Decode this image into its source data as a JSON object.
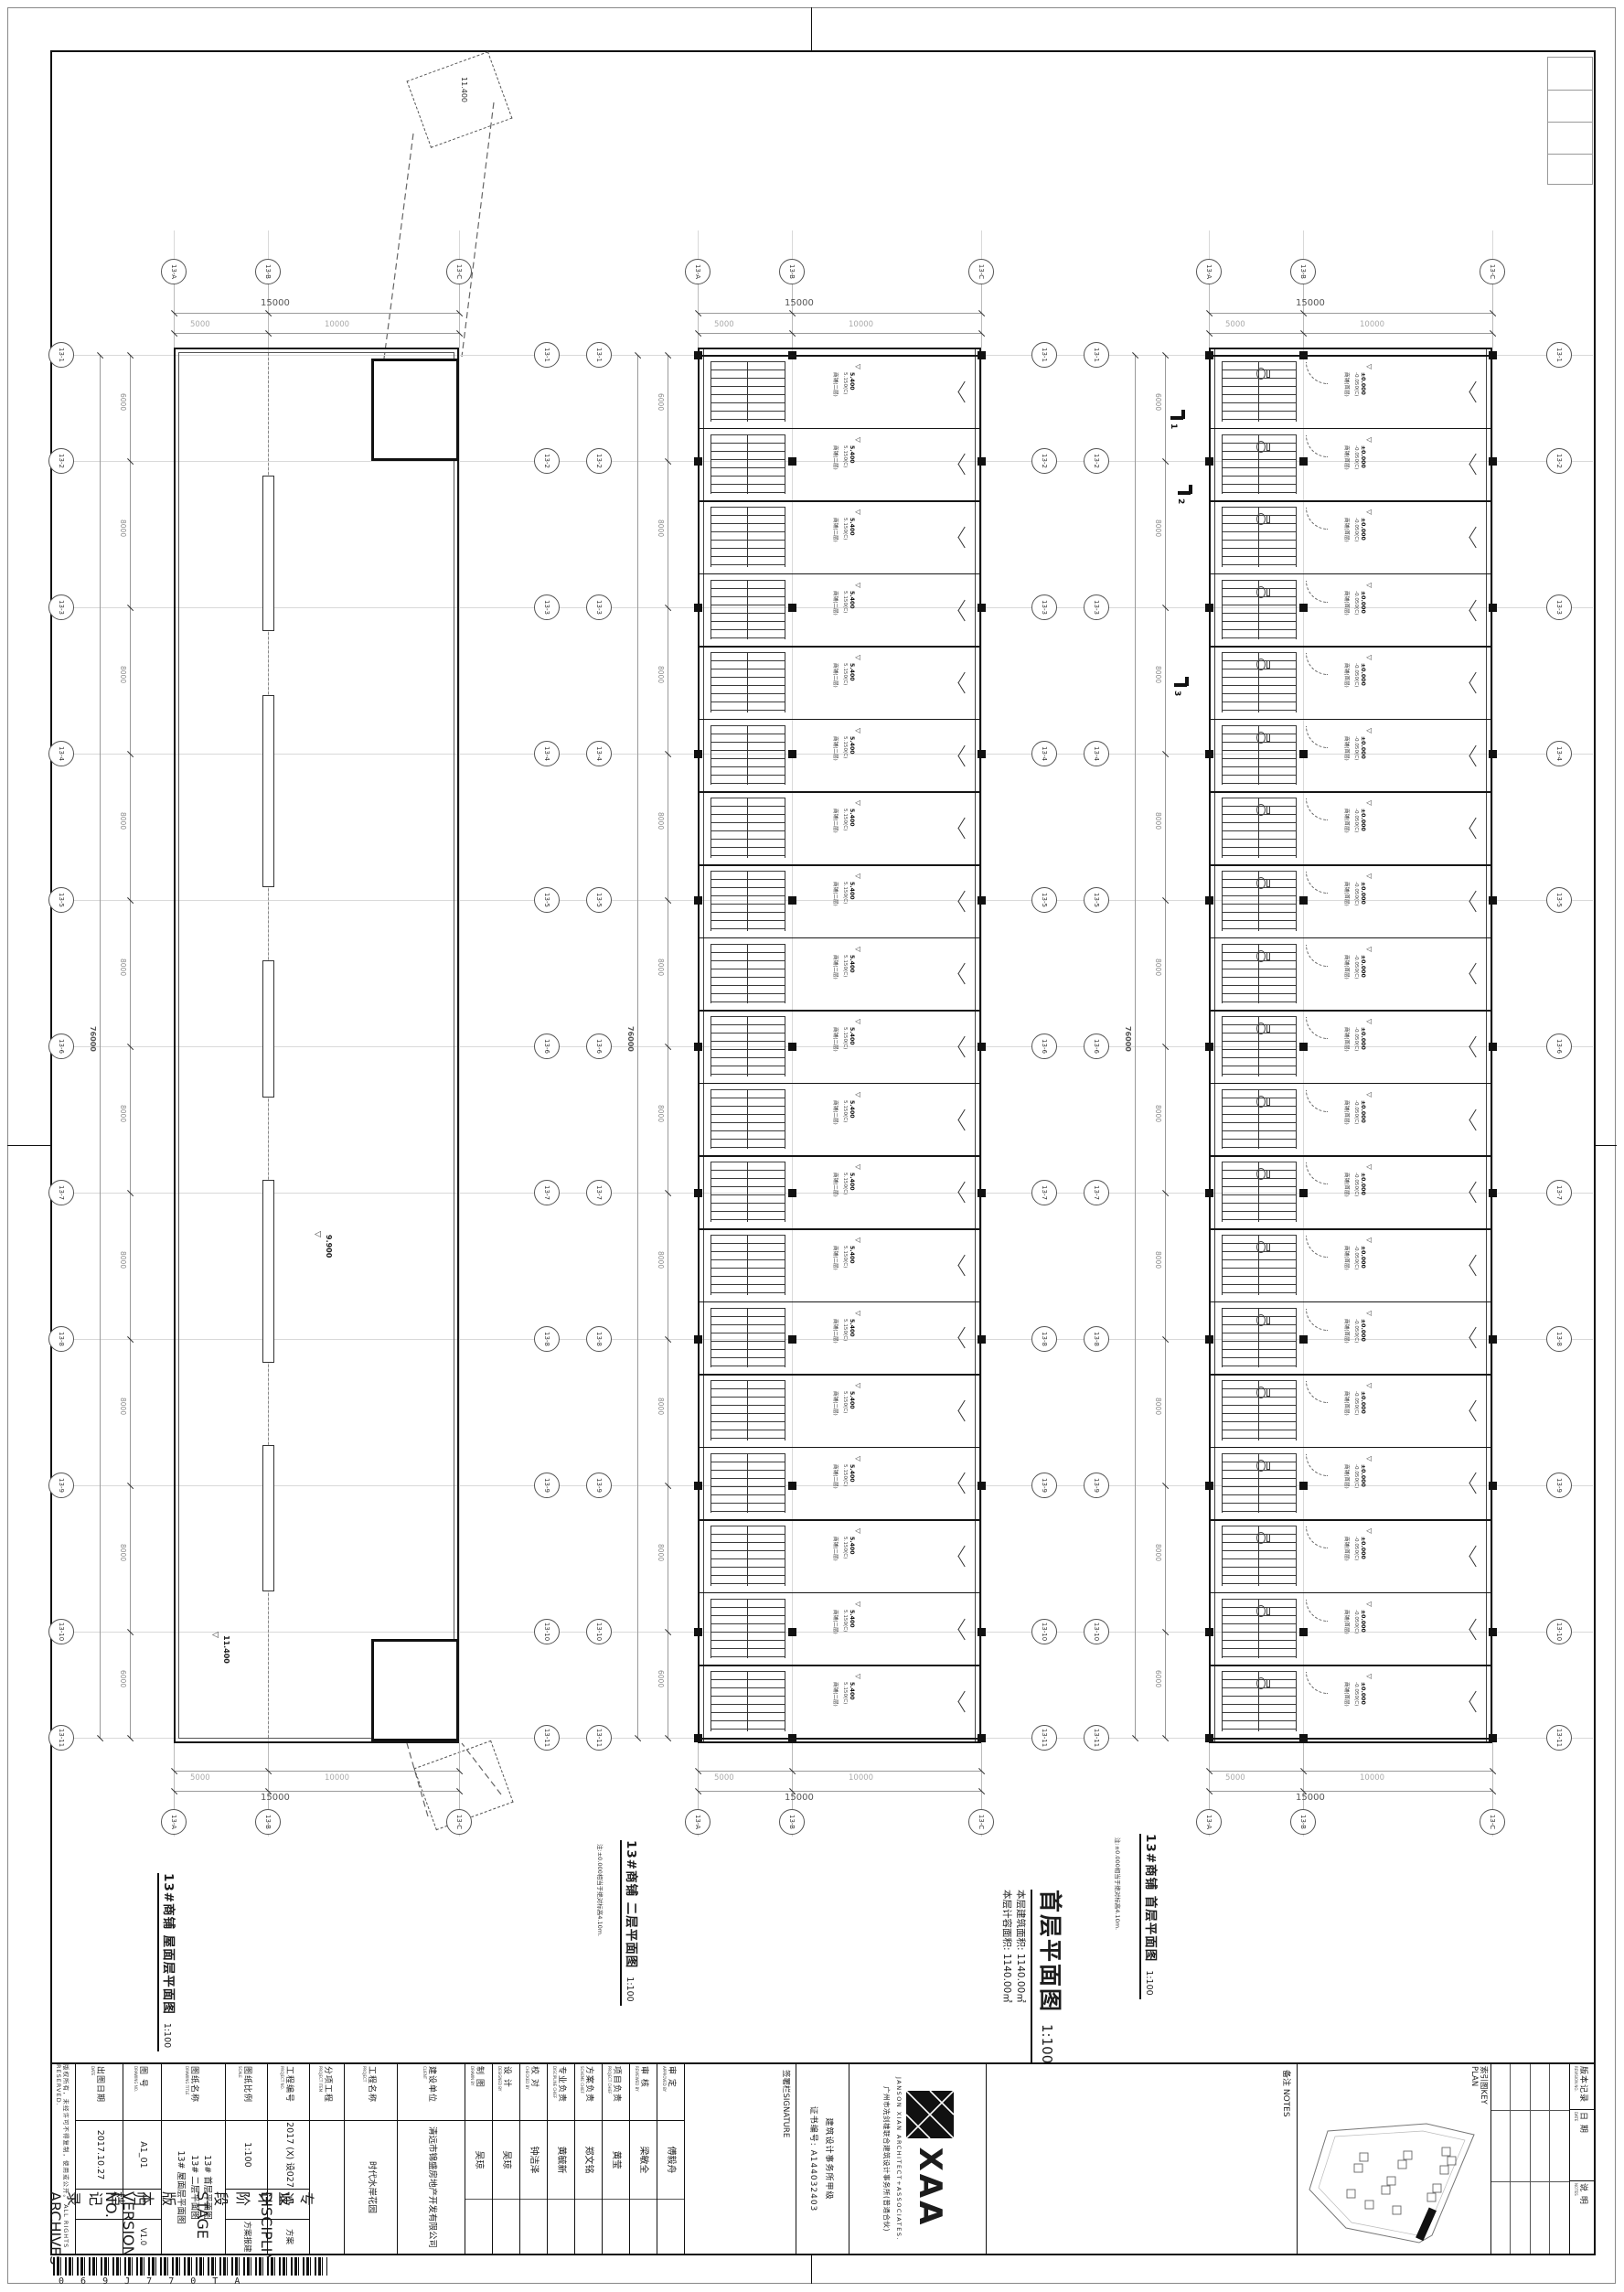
{
  "page": {
    "bg": "#ffffff",
    "ink": "#1c1c1c",
    "faint": "#d2d2d2",
    "dim": "#a0a0a0"
  },
  "frame": {
    "copyright": "版权所有，未经许可不得复制，使用或公开。 ALL RIGHTS RESERVED.",
    "barcode_text": "0 6 9  J 7 7 0 T A"
  },
  "grid": {
    "row_labels": [
      "13-1",
      "13-2",
      "13-3",
      "13-4",
      "13-5",
      "13-6",
      "13-7",
      "13-8",
      "13-9",
      "13-10",
      "13-11"
    ],
    "row_dims": [
      "6000",
      "8000",
      "8000",
      "8000",
      "8000",
      "8000",
      "8000",
      "8000",
      "8000",
      "6000"
    ],
    "row_total": "76000",
    "col_labels": [
      "13-A",
      "13-B",
      "13-C"
    ],
    "col_dims": [
      "5000",
      "10000"
    ],
    "col_total": "15000"
  },
  "plans": [
    {
      "key": "roof",
      "title": "13#商铺 屋面层平面图",
      "scale": "1:100",
      "levels": {
        "bulkhead": "11.400",
        "main": "9.900",
        "parapet": "11.400"
      }
    },
    {
      "key": "second",
      "title": "13#商铺 二层平面图",
      "scale": "1:100",
      "note": "注:±0.000相当于绝对标高4.10m.",
      "unit": {
        "name": "商铺(二层)",
        "lvl1": "5.400",
        "lvl2": "5.150(C)"
      }
    },
    {
      "key": "first",
      "title": "13#商铺 首层平面图",
      "scale": "1:100",
      "note": "注:±0.000相当于绝对标高4.10m.",
      "unit": {
        "name": "商铺(首层)",
        "lvl1": "±0.000",
        "lvl2": "-0.050(C)"
      }
    }
  ],
  "main_title": {
    "text": "首层平面图",
    "scale": "1:100",
    "area_line1": "本层建筑面积: 1140.00㎡",
    "area_line2": "本层计容面积: 1140.00㎡"
  },
  "sections": [
    "1",
    "2",
    "3"
  ],
  "titleblock": {
    "rows": [
      {
        "zh": "出图日期",
        "en": "DATE",
        "value": "2017.10.27",
        "sub": {
          "zh": "归档记录",
          "en": "ARCHIVES",
          "value": ""
        }
      },
      {
        "zh": "图  号",
        "en": "DRAWING NO.",
        "value": "A1_01",
        "sub": {
          "zh": "版  本",
          "en": "VERSION NO.",
          "value": "V1.0"
        }
      },
      {
        "zh": "图纸名称",
        "en": "DRAWING TITLE",
        "value": "13# 首层平面图\n13# 二层平面图\n13# 屋面层平面图"
      },
      {
        "zh": "图纸比例",
        "en": "SCALE",
        "value": "1:100",
        "sub": {
          "zh": "设计阶段",
          "en": "STAGE",
          "value": "方案报建"
        }
      },
      {
        "zh": "工程编号",
        "en": "PROJECT NO.",
        "value": "2017 (X) 设027",
        "sub": {
          "zh": "专  业",
          "en": "DISCIPLINE",
          "value": "方案"
        }
      },
      {
        "zh": "分项工程",
        "en": "PROJECT ITEM",
        "value": ""
      },
      {
        "zh": "工程名称",
        "en": "PROJECT",
        "value": "时代水岸花园"
      },
      {
        "zh": "建设单位",
        "en": "CLIENT",
        "value": "清远市锦盛房地产开发有限公司"
      },
      {
        "zh": "制  图",
        "en": "DRAWN BY",
        "value": "吴琼"
      },
      {
        "zh": "设  计",
        "en": "DESIGNED BY",
        "value": "吴琼"
      },
      {
        "zh": "校  对",
        "en": "CHECKED BY",
        "value": "钟洁泽"
      },
      {
        "zh": "专业负责",
        "en": "DISCIPLINE CHIEF",
        "value": "黄毓新"
      },
      {
        "zh": "方案负责",
        "en": "SCHEME CHIEF",
        "value": "郑文铭"
      },
      {
        "zh": "项目负责",
        "en": "PROJECT CHIEF",
        "value": "黄莹"
      },
      {
        "zh": "审  核",
        "en": "REVIEWED BY",
        "value": "梁敏全"
      },
      {
        "zh": "审  定",
        "en": "APPROVED BY",
        "value": "傅毅舟"
      }
    ],
    "signature_label": "签署栏SIGNATURE",
    "cert_line1": "建筑设计事务所甲级",
    "cert_line2": "证书编号: A144032403",
    "logo_text": "XAA",
    "logo_en": "JANSON XIAN ARCHITECT+ASSOCIATES.",
    "logo_zh": "广州市冼剑雄联合建筑设计事务所(普通合伙)",
    "notes_label": "备注 NOTES",
    "keyplan_label": "索引图KEY PLAN",
    "revision_cols": [
      {
        "zh": "版本记录",
        "en": "REVISION NO."
      },
      {
        "zh": "日  期",
        "en": "DATE"
      },
      {
        "zh": "说  明",
        "en": "NOTES"
      }
    ]
  }
}
